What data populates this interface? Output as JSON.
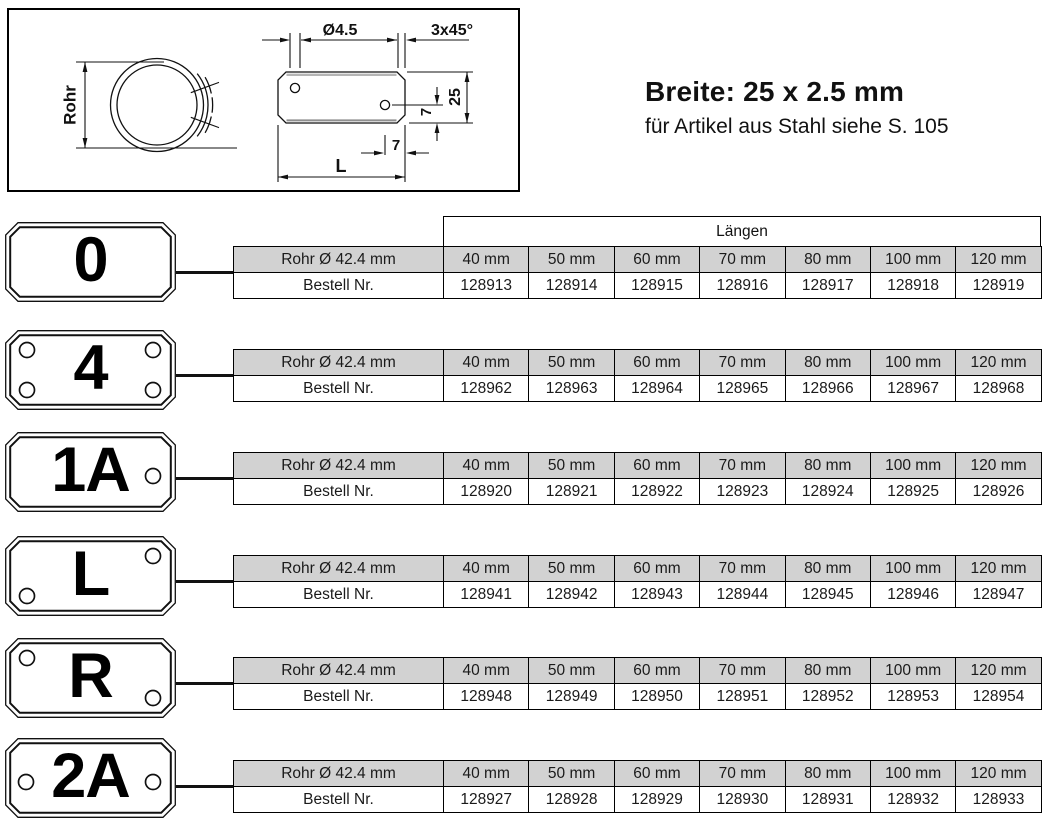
{
  "header": {
    "title": "Breite: 25 x 2.5 mm",
    "subtitle": "für Artikel aus Stahl siehe S. 105"
  },
  "drawing": {
    "pipe_label": "Rohr",
    "hole_diameter_label": "Ø4.5",
    "chamfer_label": "3x45°",
    "plate_height_label": "25",
    "hole_bottom_distance_label": "7",
    "hole_edge_distance_label": "7",
    "length_label": "L"
  },
  "table": {
    "lengths_header": "Längen",
    "row1_label": "Rohr Ø 42.4 mm",
    "row2_label": "Bestell Nr.",
    "columns": [
      "40 mm",
      "50 mm",
      "60 mm",
      "70 mm",
      "80 mm",
      "100 mm",
      "120 mm"
    ]
  },
  "rows": [
    {
      "plate": "0",
      "holes": [],
      "orders": [
        "128913",
        "128914",
        "128915",
        "128916",
        "128917",
        "128918",
        "128919"
      ]
    },
    {
      "plate": "4",
      "holes": [
        "top-left",
        "top-right",
        "bottom-left",
        "bottom-right"
      ],
      "orders": [
        "128962",
        "128963",
        "128964",
        "128965",
        "128966",
        "128967",
        "128968"
      ]
    },
    {
      "plate": "1A",
      "holes": [
        "mid-right"
      ],
      "orders": [
        "128920",
        "128921",
        "128922",
        "128923",
        "128924",
        "128925",
        "128926"
      ]
    },
    {
      "plate": "L",
      "holes": [
        "top-right",
        "bottom-left"
      ],
      "orders": [
        "128941",
        "128942",
        "128943",
        "128944",
        "128945",
        "128946",
        "128947"
      ]
    },
    {
      "plate": "R",
      "holes": [
        "top-left",
        "bottom-right"
      ],
      "orders": [
        "128948",
        "128949",
        "128950",
        "128951",
        "128952",
        "128953",
        "128954"
      ]
    },
    {
      "plate": "2A",
      "holes": [
        "mid-left",
        "mid-right"
      ],
      "orders": [
        "128927",
        "128928",
        "128929",
        "128930",
        "128931",
        "128932",
        "128933"
      ]
    }
  ],
  "colors": {
    "table_header_bg": "#d2d2d2",
    "border": "#000000",
    "text": "#111111"
  }
}
